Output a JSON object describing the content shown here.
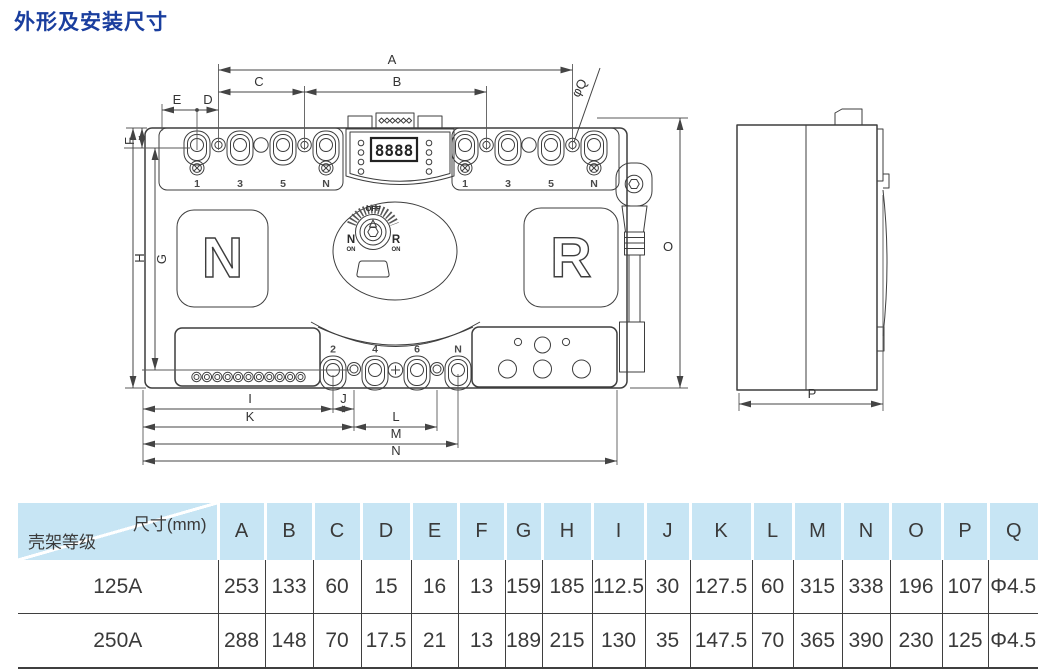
{
  "title": "外形及安装尺寸",
  "drawing": {
    "dims": {
      "A": "A",
      "B": "B",
      "C": "C",
      "D": "D",
      "E": "E",
      "F": "F",
      "G": "G",
      "H": "H",
      "I": "I",
      "J": "J",
      "K": "K",
      "L": "L",
      "M": "M",
      "N": "N",
      "O": "O",
      "P": "P",
      "phiQ": "φQ"
    },
    "front": {
      "left_letter": "N",
      "right_letter": "R",
      "display": "8888",
      "knob": {
        "off": "OFF",
        "n": "N",
        "r": "R",
        "on_left": "ON",
        "on_right": "ON"
      },
      "terminals_top_left": [
        "1",
        "3",
        "5",
        "N"
      ],
      "terminals_top_right": [
        "1",
        "3",
        "5",
        "N"
      ],
      "terminals_bottom": [
        "2",
        "4",
        "6",
        "N"
      ]
    }
  },
  "table": {
    "corner": {
      "top": "尺寸(mm)",
      "bottom": "壳架等级"
    },
    "columns": [
      "A",
      "B",
      "C",
      "D",
      "E",
      "F",
      "G",
      "H",
      "I",
      "J",
      "K",
      "L",
      "M",
      "N",
      "O",
      "P",
      "Q"
    ],
    "rows": [
      {
        "model": "125A",
        "values": [
          "253",
          "133",
          "60",
          "15",
          "16",
          "13",
          "159",
          "185",
          "112.5",
          "30",
          "127.5",
          "60",
          "315",
          "338",
          "196",
          "107",
          "Φ4.5"
        ]
      },
      {
        "model": "250A",
        "values": [
          "288",
          "148",
          "70",
          "17.5",
          "21",
          "13",
          "189",
          "215",
          "130",
          "35",
          "147.5",
          "70",
          "365",
          "390",
          "230",
          "125",
          "Φ4.5"
        ]
      }
    ]
  },
  "colors": {
    "title_blue": "#1a3e9e",
    "header_bg": "#c7e5f4",
    "line": "#3d3d3d"
  }
}
